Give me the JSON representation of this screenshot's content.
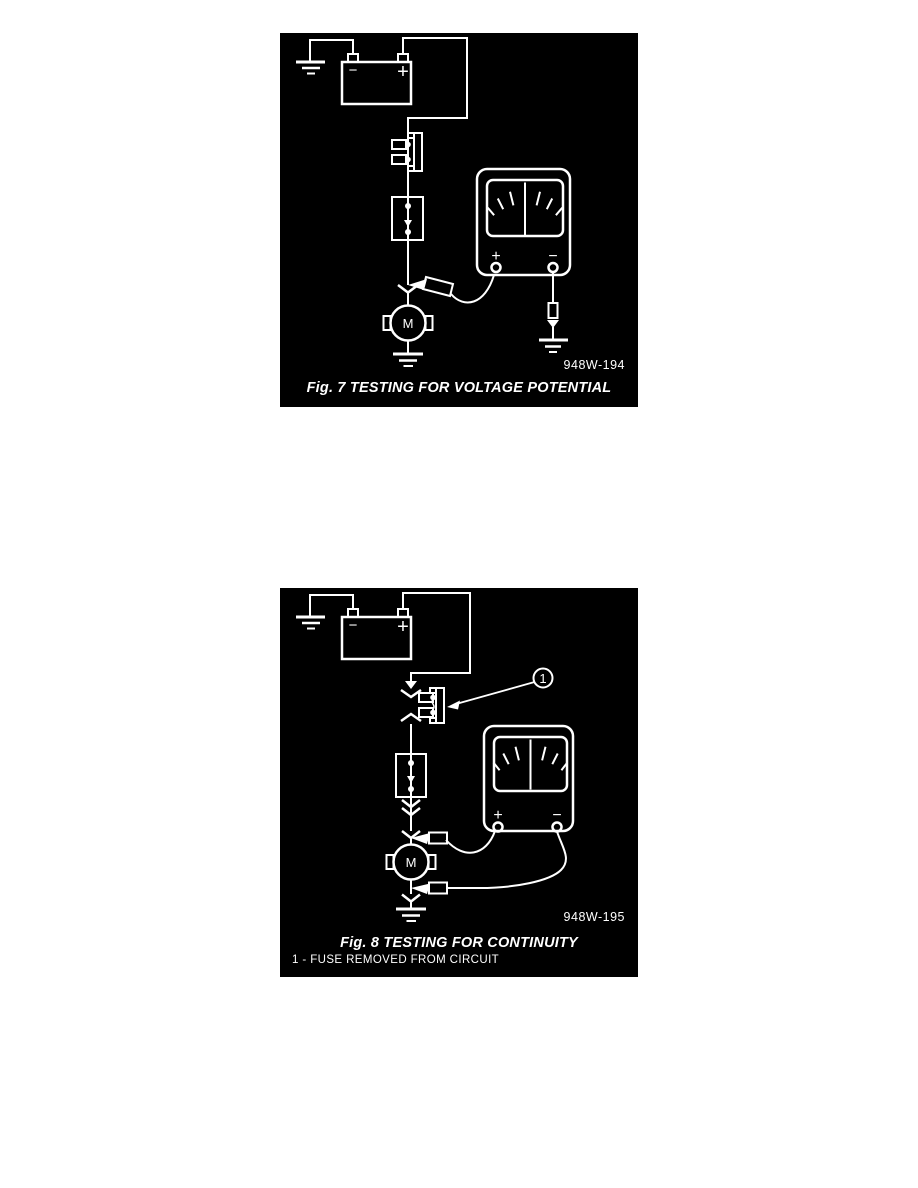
{
  "colors": {
    "page_bg": "#ffffff",
    "panel_bg": "#000000",
    "line": "#ffffff"
  },
  "figure1": {
    "caption": "Fig. 7 TESTING FOR VOLTAGE POTENTIAL",
    "part_code": "948W-194",
    "battery": {
      "negative_label": "−",
      "positive_label": "+"
    },
    "meter": {
      "positive_label": "+",
      "negative_label": "−"
    },
    "motor_label": "M"
  },
  "figure2": {
    "caption": "Fig. 8 TESTING FOR CONTINUITY",
    "part_code": "948W-195",
    "callout": {
      "number": "1"
    },
    "footnote": "1 - FUSE REMOVED FROM CIRCUIT",
    "battery": {
      "negative_label": "−",
      "positive_label": "+"
    },
    "meter": {
      "positive_label": "+",
      "negative_label": "−"
    },
    "motor_label": "M"
  }
}
